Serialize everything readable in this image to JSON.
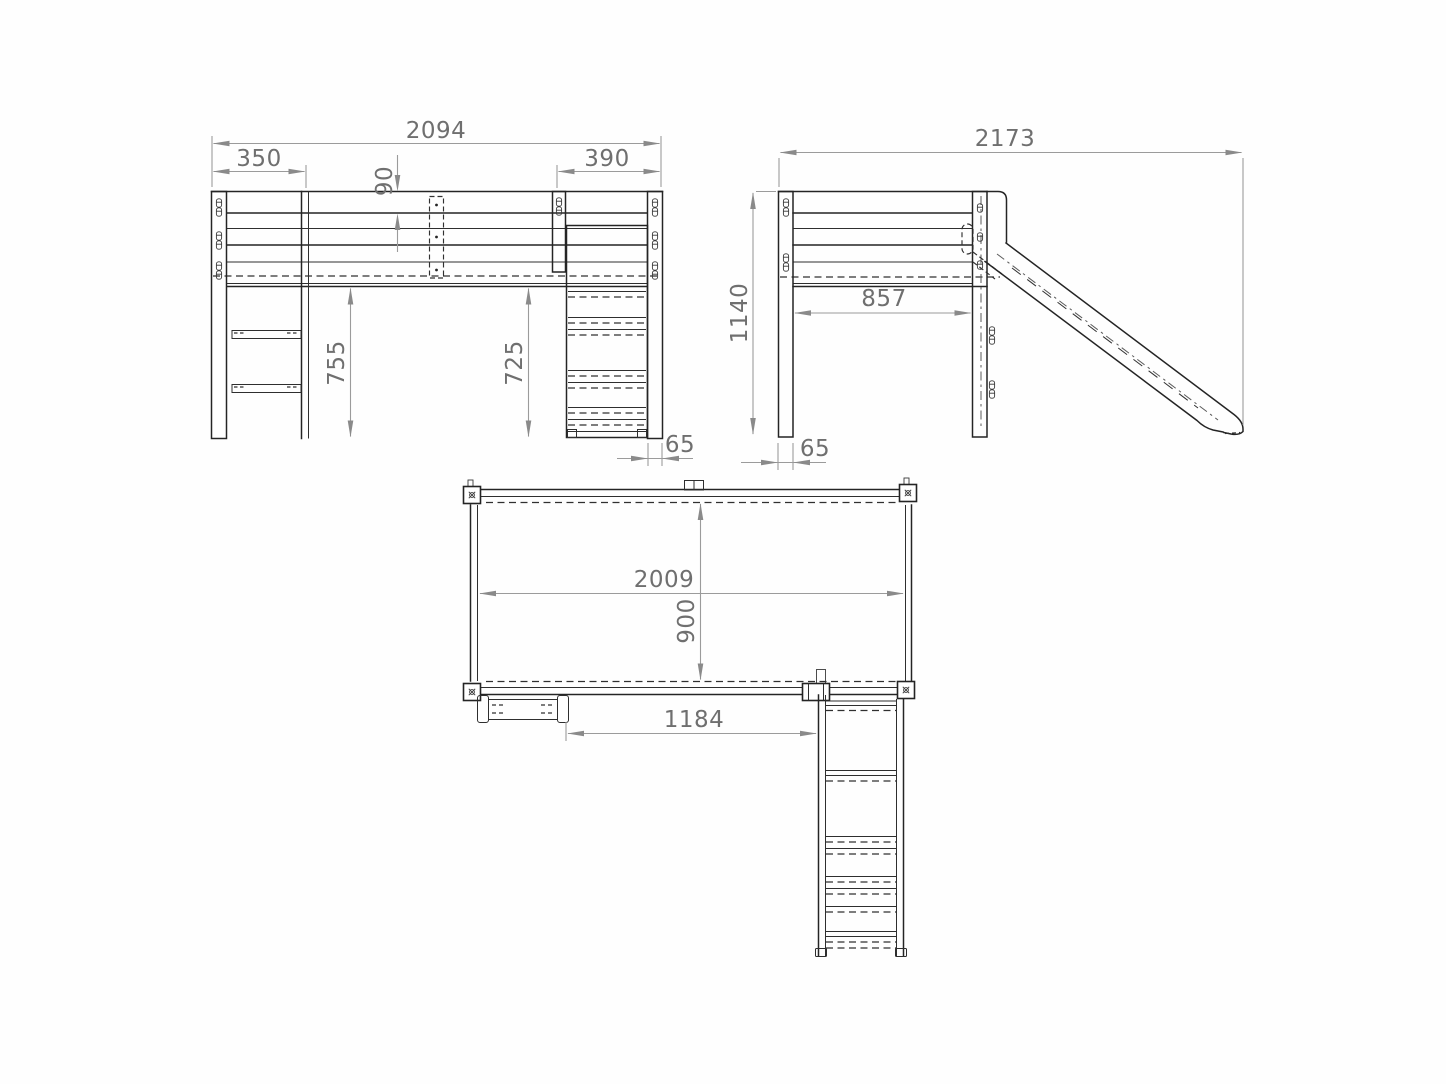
{
  "drawing": {
    "kind": "furniture dimensional drawing, three orthographic views of a loft bed with slide",
    "colors": {
      "background": "#fefefe",
      "structure_line": "#242424",
      "dimension_line": "#9b9b9b",
      "dimension_text": "#6f6f6f"
    },
    "views": {
      "front": {
        "dims": {
          "overall_width": "2094",
          "shelf_section_width": "350",
          "slide_section_width": "390",
          "guard_rail_height": "90",
          "clearance_left": "755",
          "clearance_right": "725",
          "post_thickness": "65"
        }
      },
      "side": {
        "dims": {
          "overall_depth": "2173",
          "overall_height": "1140",
          "inner_span": "857",
          "post_thickness": "65"
        }
      },
      "top": {
        "dims": {
          "inner_length": "2009",
          "inner_depth": "900",
          "slide_offset": "1184"
        }
      }
    }
  }
}
